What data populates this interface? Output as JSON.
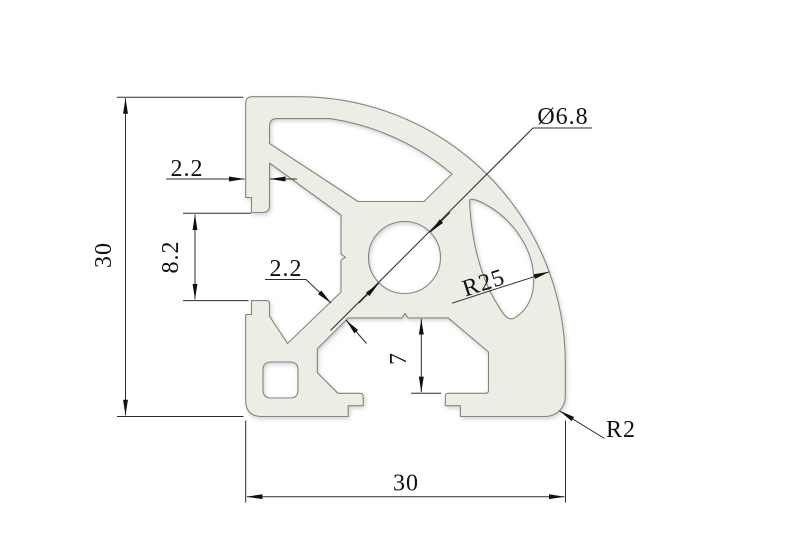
{
  "drawing": {
    "title": "aluminum extrusion profile cross-section",
    "view": "2D dimensioned drawing",
    "dims": {
      "height_left": {
        "label": "30"
      },
      "width_bottom": {
        "label": "30"
      },
      "wall_thickness": {
        "label": "2.2"
      },
      "web_thickness": {
        "label": "2.2"
      },
      "slot_opening": {
        "label": "8.2"
      },
      "slot_depth": {
        "label": "7"
      },
      "center_hole": {
        "label": "Ø6.8"
      },
      "corner_radius": {
        "label": "R25"
      },
      "edge_radius": {
        "label": "R2"
      }
    },
    "colors": {
      "bg": "#ffffff",
      "profile_fill": "#eceee6",
      "profile_stroke": "#85867f",
      "dim": "#2b2b2b",
      "ink": "#111111"
    }
  }
}
